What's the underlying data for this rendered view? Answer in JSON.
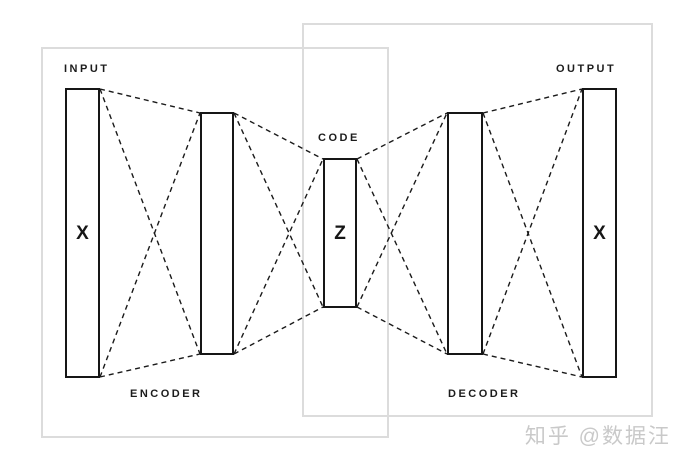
{
  "canvas": {
    "width": 681,
    "height": 463,
    "background": "#ffffff"
  },
  "colors": {
    "line": "#1a1a1a",
    "rect_border": "#161616",
    "rect_fill": "#ffffff",
    "region_border": "#dcdcdc",
    "label_text": "#1c1c1c",
    "watermark_text": "#c9c9c9"
  },
  "diagram": {
    "type": "autoencoder-architecture",
    "layers": [
      {
        "id": "input",
        "symbol": "X",
        "x": 65,
        "y": 88,
        "w": 35,
        "h": 290
      },
      {
        "id": "hidden-1",
        "symbol": "",
        "x": 200,
        "y": 112,
        "w": 34,
        "h": 243
      },
      {
        "id": "code",
        "symbol": "Z",
        "x": 323,
        "y": 158,
        "w": 34,
        "h": 150
      },
      {
        "id": "hidden-2",
        "symbol": "",
        "x": 447,
        "y": 112,
        "w": 36,
        "h": 243
      },
      {
        "id": "output",
        "symbol": "X",
        "x": 582,
        "y": 88,
        "w": 35,
        "h": 290
      }
    ],
    "labels": [
      {
        "id": "input-label",
        "text": "INPUT",
        "x": 64,
        "y": 63
      },
      {
        "id": "code-label",
        "text": "CODE",
        "x": 318,
        "y": 132
      },
      {
        "id": "output-label",
        "text": "OUTPUT",
        "x": 556,
        "y": 63
      },
      {
        "id": "encoder-label",
        "text": "ENCODER",
        "x": 130,
        "y": 388
      },
      {
        "id": "decoder-label",
        "text": "DECODER",
        "x": 448,
        "y": 388
      }
    ],
    "regions": [
      {
        "id": "encoder-region",
        "x": 41,
        "y": 47,
        "w": 348,
        "h": 391
      },
      {
        "id": "decoder-region",
        "x": 302,
        "y": 23,
        "w": 351,
        "h": 394
      }
    ],
    "connections": [
      [
        0,
        1
      ],
      [
        1,
        2
      ],
      [
        2,
        3
      ],
      [
        3,
        4
      ]
    ],
    "line_style": {
      "stroke_width": 1.4,
      "dash": "5,4"
    }
  },
  "watermark": {
    "text": "知乎 @数据汪"
  }
}
